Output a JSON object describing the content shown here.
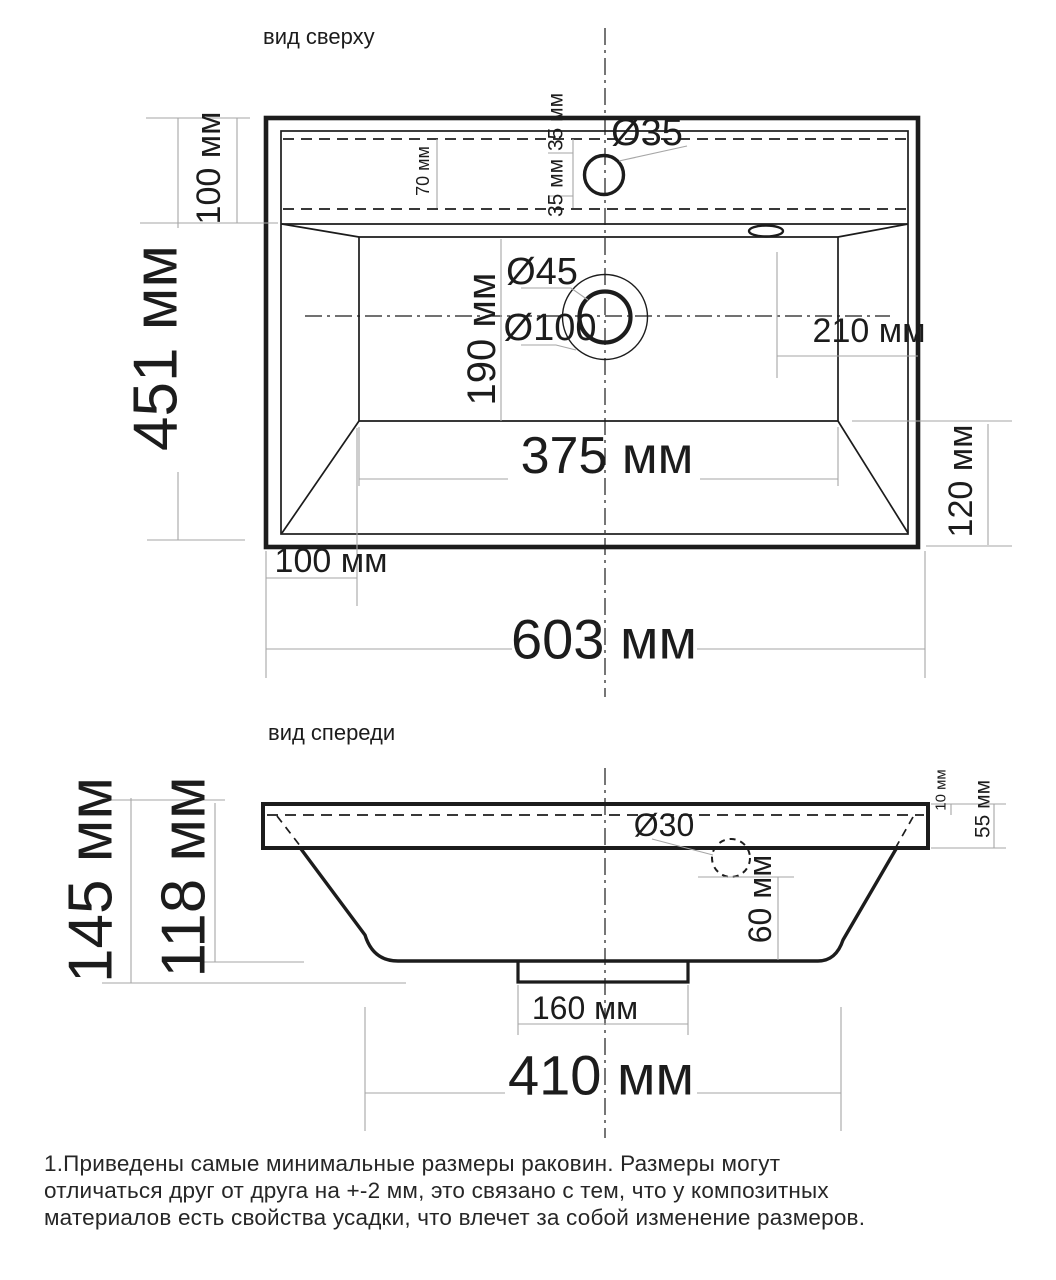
{
  "colors": {
    "line": "#1c1c1c",
    "dim": "#a6a6a6",
    "bg": "#ffffff",
    "note": "#262626"
  },
  "top_view": {
    "title": "вид сверху",
    "dim_deck_depth": "100 мм",
    "dim_total_depth": "451 мм",
    "dim_strip": "70 мм",
    "dim_faucet_above": "35 мм",
    "dim_faucet_below": "35 мм",
    "dim_faucet_dia": "Ø35",
    "dim_drain_dia": "Ø45",
    "dim_recess_dia": "Ø100",
    "dim_basin_depth": "190 мм",
    "dim_right": "210 мм",
    "dim_basin_width": "375 мм",
    "dim_front_wall": "120 мм",
    "dim_left_offset": "100 мм",
    "dim_total_width": "603 мм"
  },
  "front_view": {
    "title": "вид спереди",
    "dim_total_height": "145 мм",
    "dim_bowl_height": "118 мм",
    "dim_lip": "10 мм",
    "dim_rim": "55 мм",
    "dim_overflow_dia": "Ø30",
    "dim_overflow_drop": "60 мм",
    "dim_drain_block_width": "160 мм",
    "dim_bottom_width": "410 мм"
  },
  "note": {
    "line1": "1.Приведены самые минимальные размеры раковин. Размеры могут",
    "line2": "отличаться друг от друга на +-2 мм, это связано с тем, что у композитных",
    "line3": "материалов есть свойства усадки, что влечет за собой изменение размеров."
  }
}
